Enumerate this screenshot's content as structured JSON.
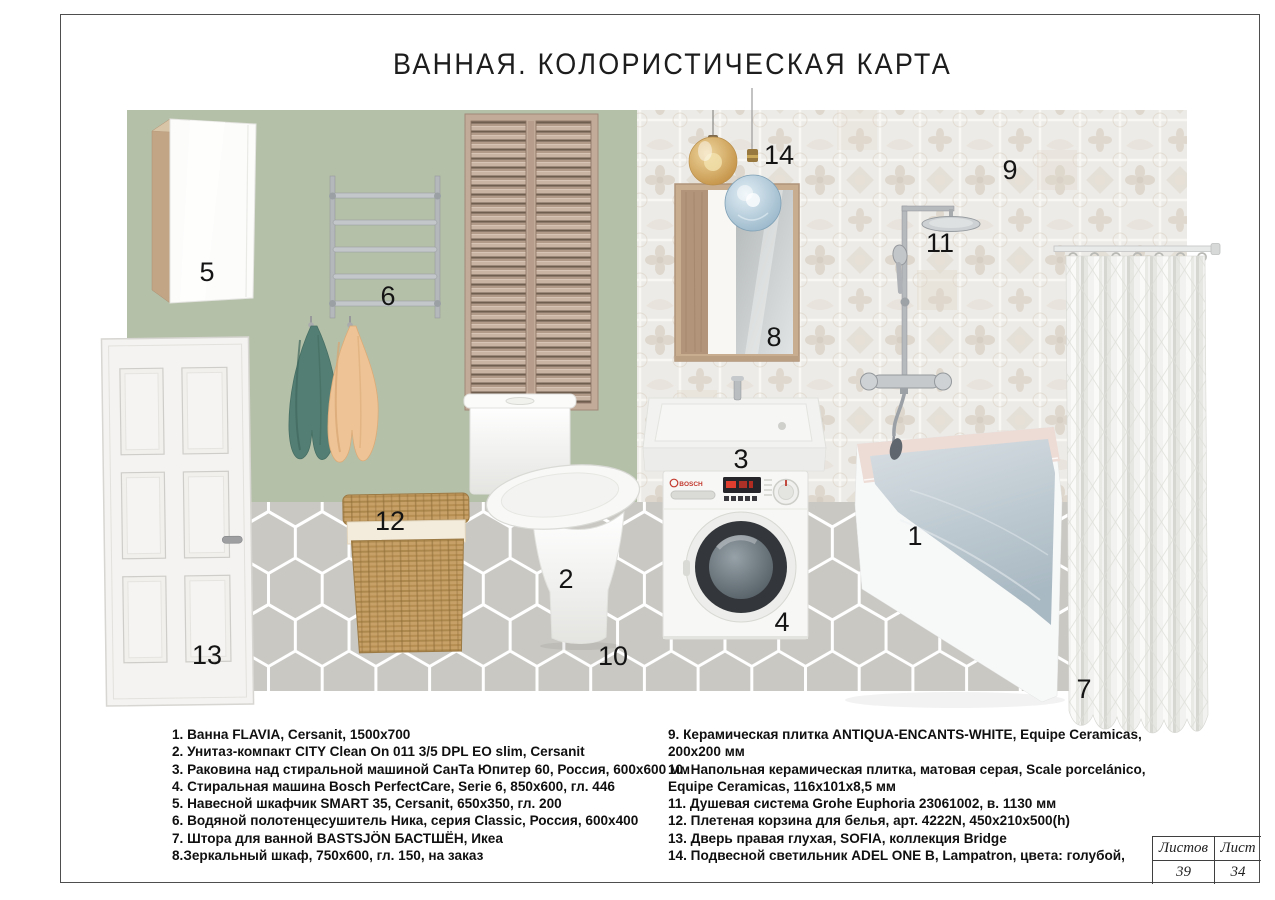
{
  "title": "ВАННАЯ. КОЛОРИСТИЧЕСКАЯ КАРТА",
  "labels": {
    "n1": "1",
    "n2": "2",
    "n3": "3",
    "n4": "4",
    "n5": "5",
    "n6": "6",
    "n7": "7",
    "n8": "8",
    "n9": "9",
    "n10": "10",
    "n11": "11",
    "n12": "12",
    "n13": "13",
    "n14": "14"
  },
  "legend": {
    "left": [
      "1. Ванна FLAVIA, Cersanit, 1500x700",
      "2. Унитаз-компакт CITY Clean On 011 3/5 DPL EO slim, Cersanit",
      "3. Раковина над стиральной машиной СанТа Юпитер 60, Россия, 600x600 мм",
      "4. Стиральная машина Bosch PerfectCare, Serie 6, 850x600, гл. 446",
      "5. Навесной шкафчик SMART 35, Cersanit, 650x350, гл. 200",
      "6. Водяной полотенцесушитель Ника, серия Classic, Россия, 600x400",
      "7. Штора для ванной BASTSJÖN БАСТШЁН, Икеа",
      "8.Зеркальный шкаф, 750x600, гл. 150, на заказ"
    ],
    "right": [
      "9. Керамическая плитка ANTIQUA-ENCANTS-WHITE, Equipe Ceramicas,",
      "200x200 мм",
      "10. Напольная керамическая плитка, матовая серая, Scale porcelánico,",
      "Equipe Ceramicas, 116x101x8,5 мм",
      "11. Душевая система Grohe Euphoria 23061002, в. 1130 мм",
      "12. Плетеная корзина для белья, арт. 4222N, 450x210x500(h)",
      "13. Дверь правая глухая, SOFIA, коллекция Bridge",
      "14. Подвесной светильник ADEL ONE B, Lampatron, цвета: голубой,"
    ]
  },
  "sheet_table": {
    "total_label": "Листов",
    "total_value": "39",
    "current_label": "Лист",
    "current_value": "34"
  },
  "colors": {
    "wall_green": "#b5c0a9",
    "wall_tile": "#edebe7",
    "tile_motif": "#d9d0c4",
    "floor_gray": "#c9c8c3",
    "grout_white": "#ffffff",
    "shutter_wood": "#c3ab9a",
    "towel_teal": "#537e73",
    "towel_peach": "#eec496",
    "wicker": "#c6a067",
    "chrome": "#b6babd",
    "bath_rim_pink": "#eddbd5",
    "water_blue": "#b9c6cf",
    "pendant_amber": "#d8a65c",
    "pendant_blue": "#a9c3d4",
    "display_red": "#e03f2f",
    "ink": "#1d1d1d"
  }
}
